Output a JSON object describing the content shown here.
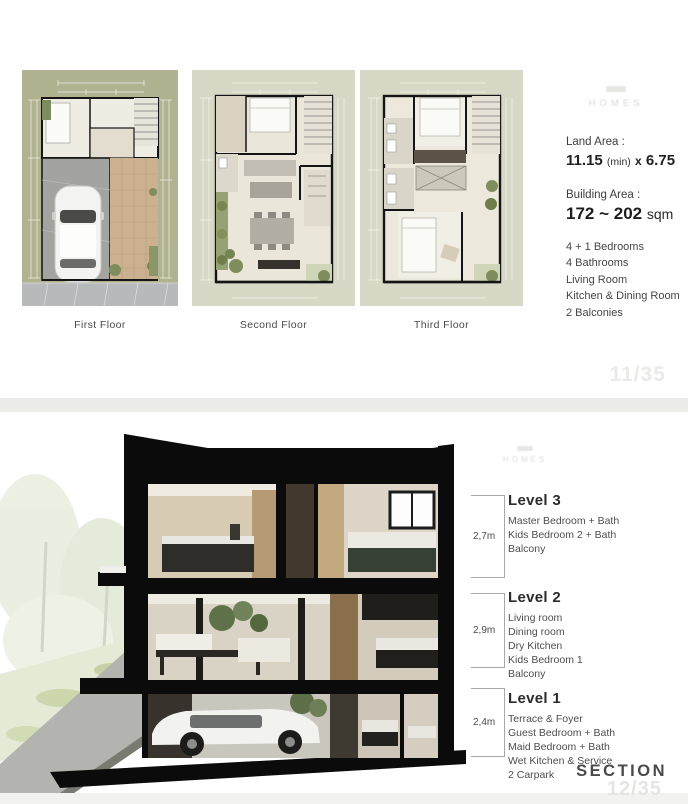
{
  "slide1": {
    "brand": "HOMES",
    "plans": [
      {
        "label": "First Floor"
      },
      {
        "label": "Second Floor"
      },
      {
        "label": "Third Floor"
      }
    ],
    "land_area": {
      "label": "Land Area :",
      "width": "11.15",
      "min_note": "(min)",
      "times": "x",
      "depth": "6.75"
    },
    "building_area": {
      "label": "Building Area :",
      "value": "172 ~ 202",
      "unit": "sqm"
    },
    "features": [
      "4 + 1 Bedrooms",
      "4  Bathrooms",
      "Living Room",
      "Kitchen & Dining Room",
      "2 Balconies"
    ],
    "page": "11/35"
  },
  "slide2": {
    "brand": "HOMES",
    "levels": [
      {
        "name": "Level 3",
        "height": "2,7m",
        "items": [
          "Master Bedroom + Bath",
          "Kids Bedroom 2 + Bath",
          "Balcony"
        ]
      },
      {
        "name": "Level 2",
        "height": "2,9m",
        "items": [
          "Living room",
          "Dining room",
          "Dry Kitchen",
          "Kids Bedroom 1",
          "Balcony"
        ]
      },
      {
        "name": "Level 1",
        "height": "2,4m",
        "items": [
          "Terrace & Foyer",
          "Guest Bedroom + Bath",
          "Maid Bedroom + Bath",
          "Wet Kitchen & Service",
          "2 Carpark"
        ]
      }
    ],
    "section_label": "SECTION",
    "page": "12/35"
  },
  "colors": {
    "plan1_ground": "#b1b290",
    "plan23_ground": "#d7d8c6",
    "wall_black": "#0b0b0b",
    "page_number_gray": "#e8e8e6"
  }
}
